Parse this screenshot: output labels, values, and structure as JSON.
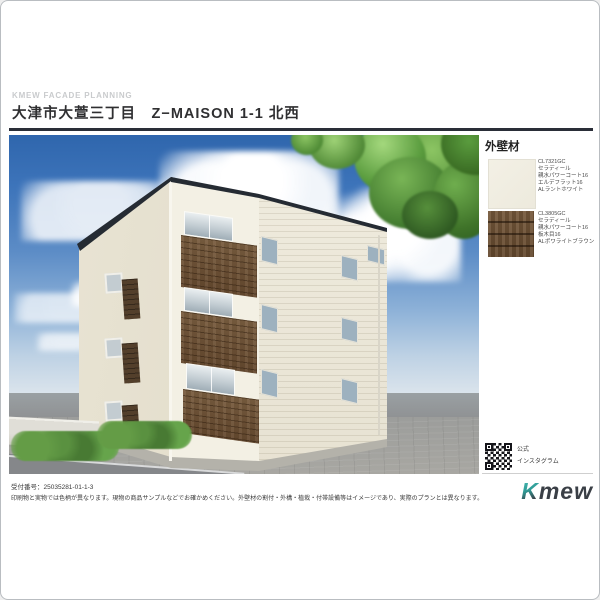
{
  "page": {
    "eyebrow": "KMEW FACADE PLANNING",
    "title": "大津市大萱三丁目　Z−MAISON 1-1 北西"
  },
  "sidebar": {
    "heading": "外壁材",
    "materials": [
      {
        "code": "CL7321GC",
        "line1": "セラディール",
        "line2": "親水パワーコート16",
        "line3": "エルデフラット16",
        "line4": "ALラントホワイト",
        "swatch_color": "#f2efe4"
      },
      {
        "code": "CL3805GC",
        "line1": "セラディール",
        "line2": "親水パワーコート16",
        "line3": "板木目16",
        "line4": "ALポワライトブラウン",
        "swatch_color": "#6b5138"
      }
    ],
    "qr_label_line1": "公式",
    "qr_label_line2": "インスタグラム"
  },
  "footer": {
    "receipt_number": "受付番号：25035281-01-1-3",
    "disclaimer": "印刷物と実物では色柄が異なります。現物の商品サンプルなどでお確かめください。外壁材の割付・外構・植栽・付帯設備等はイメージであり、実際のプランとは異なります。",
    "logo": {
      "k": "K",
      "rest": "mew"
    }
  },
  "colors": {
    "accent_teal": "#35a79d",
    "roof_dark": "#252b33",
    "wall_cream": "#f2efe3",
    "wood_brown": "#6b5138",
    "sky_top": "#2f66ad",
    "sky_horizon": "#dbe4ec",
    "shrub_green": "#4e8a35"
  }
}
